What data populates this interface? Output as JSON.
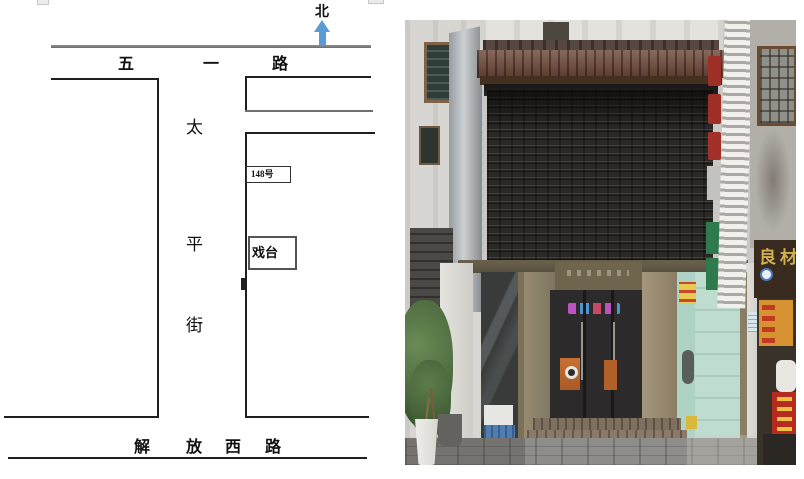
{
  "map": {
    "north": {
      "label": "北",
      "arrow_color": "#5b9bd5"
    },
    "top_road_chars": [
      "五",
      "一",
      "路"
    ],
    "street_chars": [
      "太",
      "平",
      "街"
    ],
    "bottom_road_chars": [
      "解",
      "放",
      "西",
      "路"
    ],
    "address_label": "148号",
    "stage_label": "戏台",
    "line_color": "#1f1f1f"
  },
  "photo": {
    "subject": "traditional shopfront with dark tiled lattice facade, bronze framed glass doors and stone steps",
    "neighbor_sign_text": "良材",
    "colors": {
      "roof_tiles": "#6f4838",
      "lattice": "#2a2926",
      "bronze_frame": "#8d8169",
      "teal_interior": "#bedccf",
      "neighbor_sign_brown": "#382a1e",
      "neighbor_sign_gold": "#d2b050"
    }
  }
}
